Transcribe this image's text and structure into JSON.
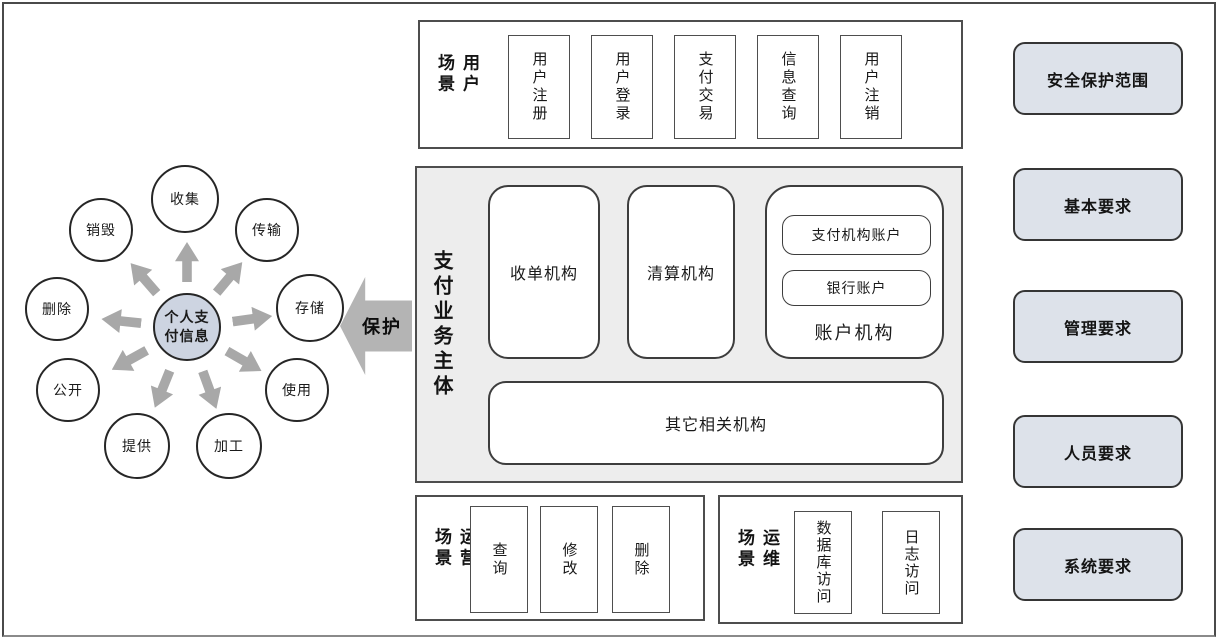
{
  "lifecycle": {
    "center_label": "个人支付信息",
    "protect_label": "保护",
    "circles": [
      {
        "id": "collect",
        "label": "收集"
      },
      {
        "id": "transmit",
        "label": "传输"
      },
      {
        "id": "store",
        "label": "存储"
      },
      {
        "id": "use",
        "label": "使用"
      },
      {
        "id": "process",
        "label": "加工"
      },
      {
        "id": "provide",
        "label": "提供"
      },
      {
        "id": "disclose",
        "label": "公开"
      },
      {
        "id": "delete",
        "label": "删除"
      },
      {
        "id": "destroy",
        "label": "销毁"
      }
    ]
  },
  "user_scenarios": {
    "label": "用户场景",
    "items": [
      "用户注册",
      "用户登录",
      "支付交易",
      "信息查询",
      "用户注销"
    ]
  },
  "payment_business_entities": {
    "label": "支付业务主体",
    "acquirer": "收单机构",
    "clearing": "清算机构",
    "account_group": {
      "label": "账户机构",
      "payment_account": "支付机构账户",
      "bank_account": "银行账户"
    },
    "other": "其它相关机构"
  },
  "operation_scenarios": {
    "label": "运营场景",
    "items": [
      "查询",
      "修改",
      "删除"
    ]
  },
  "maintenance_scenarios": {
    "label": "运维场景",
    "items": [
      "数据库访问",
      "日志访问"
    ]
  },
  "requirements": {
    "items": [
      "安全保护范围",
      "基本要求",
      "管理要求",
      "人员要求",
      "系统要求"
    ]
  },
  "colors": {
    "center_circle_fill": "#cdd4e1",
    "requirement_box_fill": "#dde2ea",
    "entity_section_fill": "#ededed",
    "radial_arrow_gray": "#a8a8a8",
    "protect_arrow_gray": "#b4b4b4",
    "border_dark": "#3d3d3d",
    "text": "#1a1a1a"
  }
}
